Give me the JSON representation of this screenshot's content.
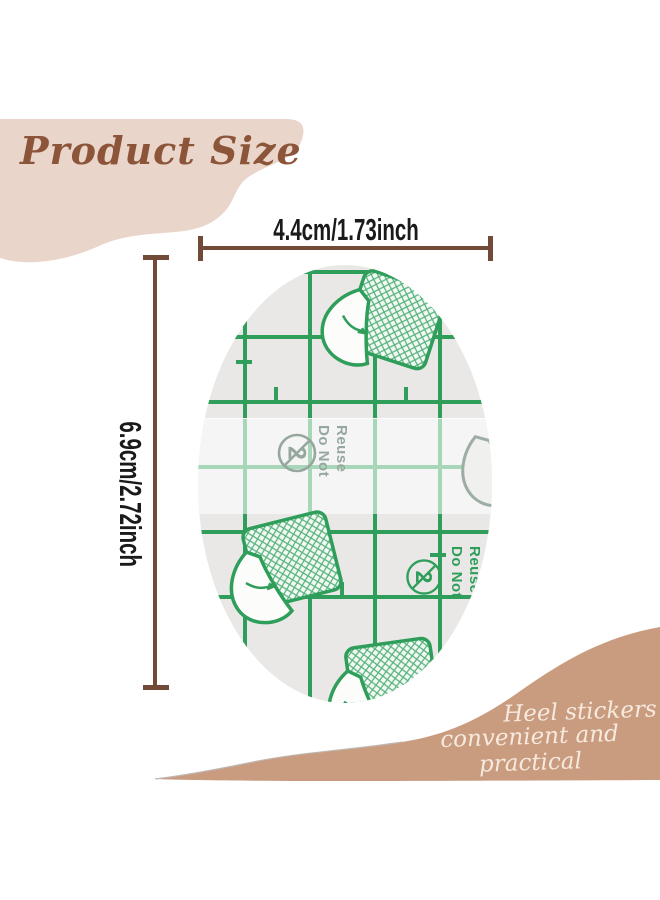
{
  "header": {
    "title": "Product Size",
    "banner_color": "#e9d5ca",
    "title_color": "#8c5438"
  },
  "dimensions": {
    "width_label": "4.4cm/1.73inch",
    "height_label": "6.9cm/2.72inch",
    "line_color": "#714a38",
    "label_color": "#1a1a1a"
  },
  "sticker": {
    "base_color": "#e9e8e6",
    "grid_color": "#2f9e5a",
    "faded_print_color": "#96a79e",
    "do_not_reuse_line1": "Do Not",
    "do_not_reuse_line2": "Reuse",
    "prohibition_number": "2"
  },
  "footer": {
    "tagline_line1": "Heel stickers",
    "tagline_line2": "convenient and practical",
    "background_color": "#ca9c7f",
    "text_color": "#f6eadf"
  },
  "icons": {
    "peel-patch-icon": "crosshatched patch with peeling corner",
    "do-not-reuse-prohibition-icon": "number 2 in circle with slash"
  }
}
